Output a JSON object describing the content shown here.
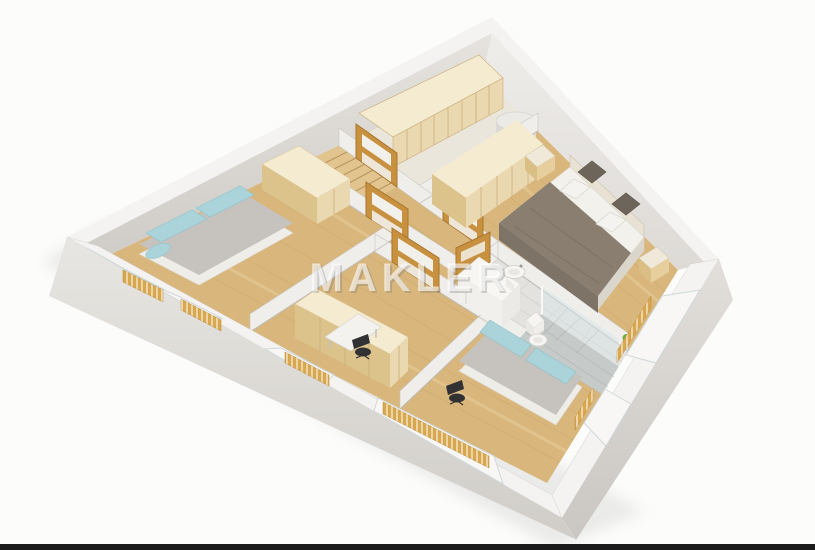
{
  "watermark": {
    "text": "MAKLER",
    "color": "#ffffff"
  },
  "scene": {
    "background": "#fcfcfb",
    "bottom_bar": "#1b1b1b",
    "palette": {
      "floor_wood": "#d9b77c",
      "floor_wood_shade": "#c7a163",
      "floor_wood_light": "#ecd3a2",
      "wall_top": "#f4f3f1",
      "wall_inner_left": "#d8d5d1",
      "wall_inner_right": "#e8e6e3",
      "wall_outer": "#ddd9d5",
      "partition": "#f0eeeb",
      "closet_floor": "#eae6dc",
      "stair_wood": "#e2c48e",
      "wardrobe_wood": "#ead9b0",
      "wardrobe_wood_top": "#f4ebd1",
      "radiator_gold": "#d9a84e",
      "door_wood": "#c8913f",
      "sofa_gray": "#c6c2bd",
      "sofa_base": "#efede8",
      "cushion_blue": "#aad3da",
      "bed_duvet": "#8a7e71",
      "bed_pillow": "#f5f3ef",
      "headboard": "#e8e2d4",
      "bath_tile": "#e3e2df",
      "shower_tile": "#c6cac9",
      "glass": "#d7e7ea",
      "ceramic": "#f6f5f2",
      "chair_dark": "#323234",
      "plant_green": "#6faf3f"
    },
    "rooms": [
      {
        "name": "room-top-left",
        "furniture": [
          "sofa-bed",
          "wardrobe",
          "windows-with-radiators"
        ]
      },
      {
        "name": "staircase-bay",
        "furniture": [
          "wooden-staircase"
        ]
      },
      {
        "name": "hallway",
        "furniture": [
          "interior-doors"
        ]
      },
      {
        "name": "storage-room",
        "furniture": [
          "wardrobe-row",
          "water-heater-cylinder"
        ]
      },
      {
        "name": "bedroom",
        "furniture": [
          "double-bed",
          "wardrobe-row",
          "nightstand-left",
          "nightstand-right",
          "window-with-radiator"
        ]
      },
      {
        "name": "bathroom",
        "furniture": [
          "toilet",
          "washbasin",
          "shower",
          "white-cabinet",
          "plant"
        ]
      },
      {
        "name": "room-bottom-left",
        "furniture": [
          "wardrobe",
          "desk",
          "office-chair",
          "windows-with-radiators"
        ]
      },
      {
        "name": "room-bottom-center",
        "furniture": [
          "sofa-bed",
          "office-chair",
          "window-with-long-radiator"
        ]
      }
    ]
  }
}
